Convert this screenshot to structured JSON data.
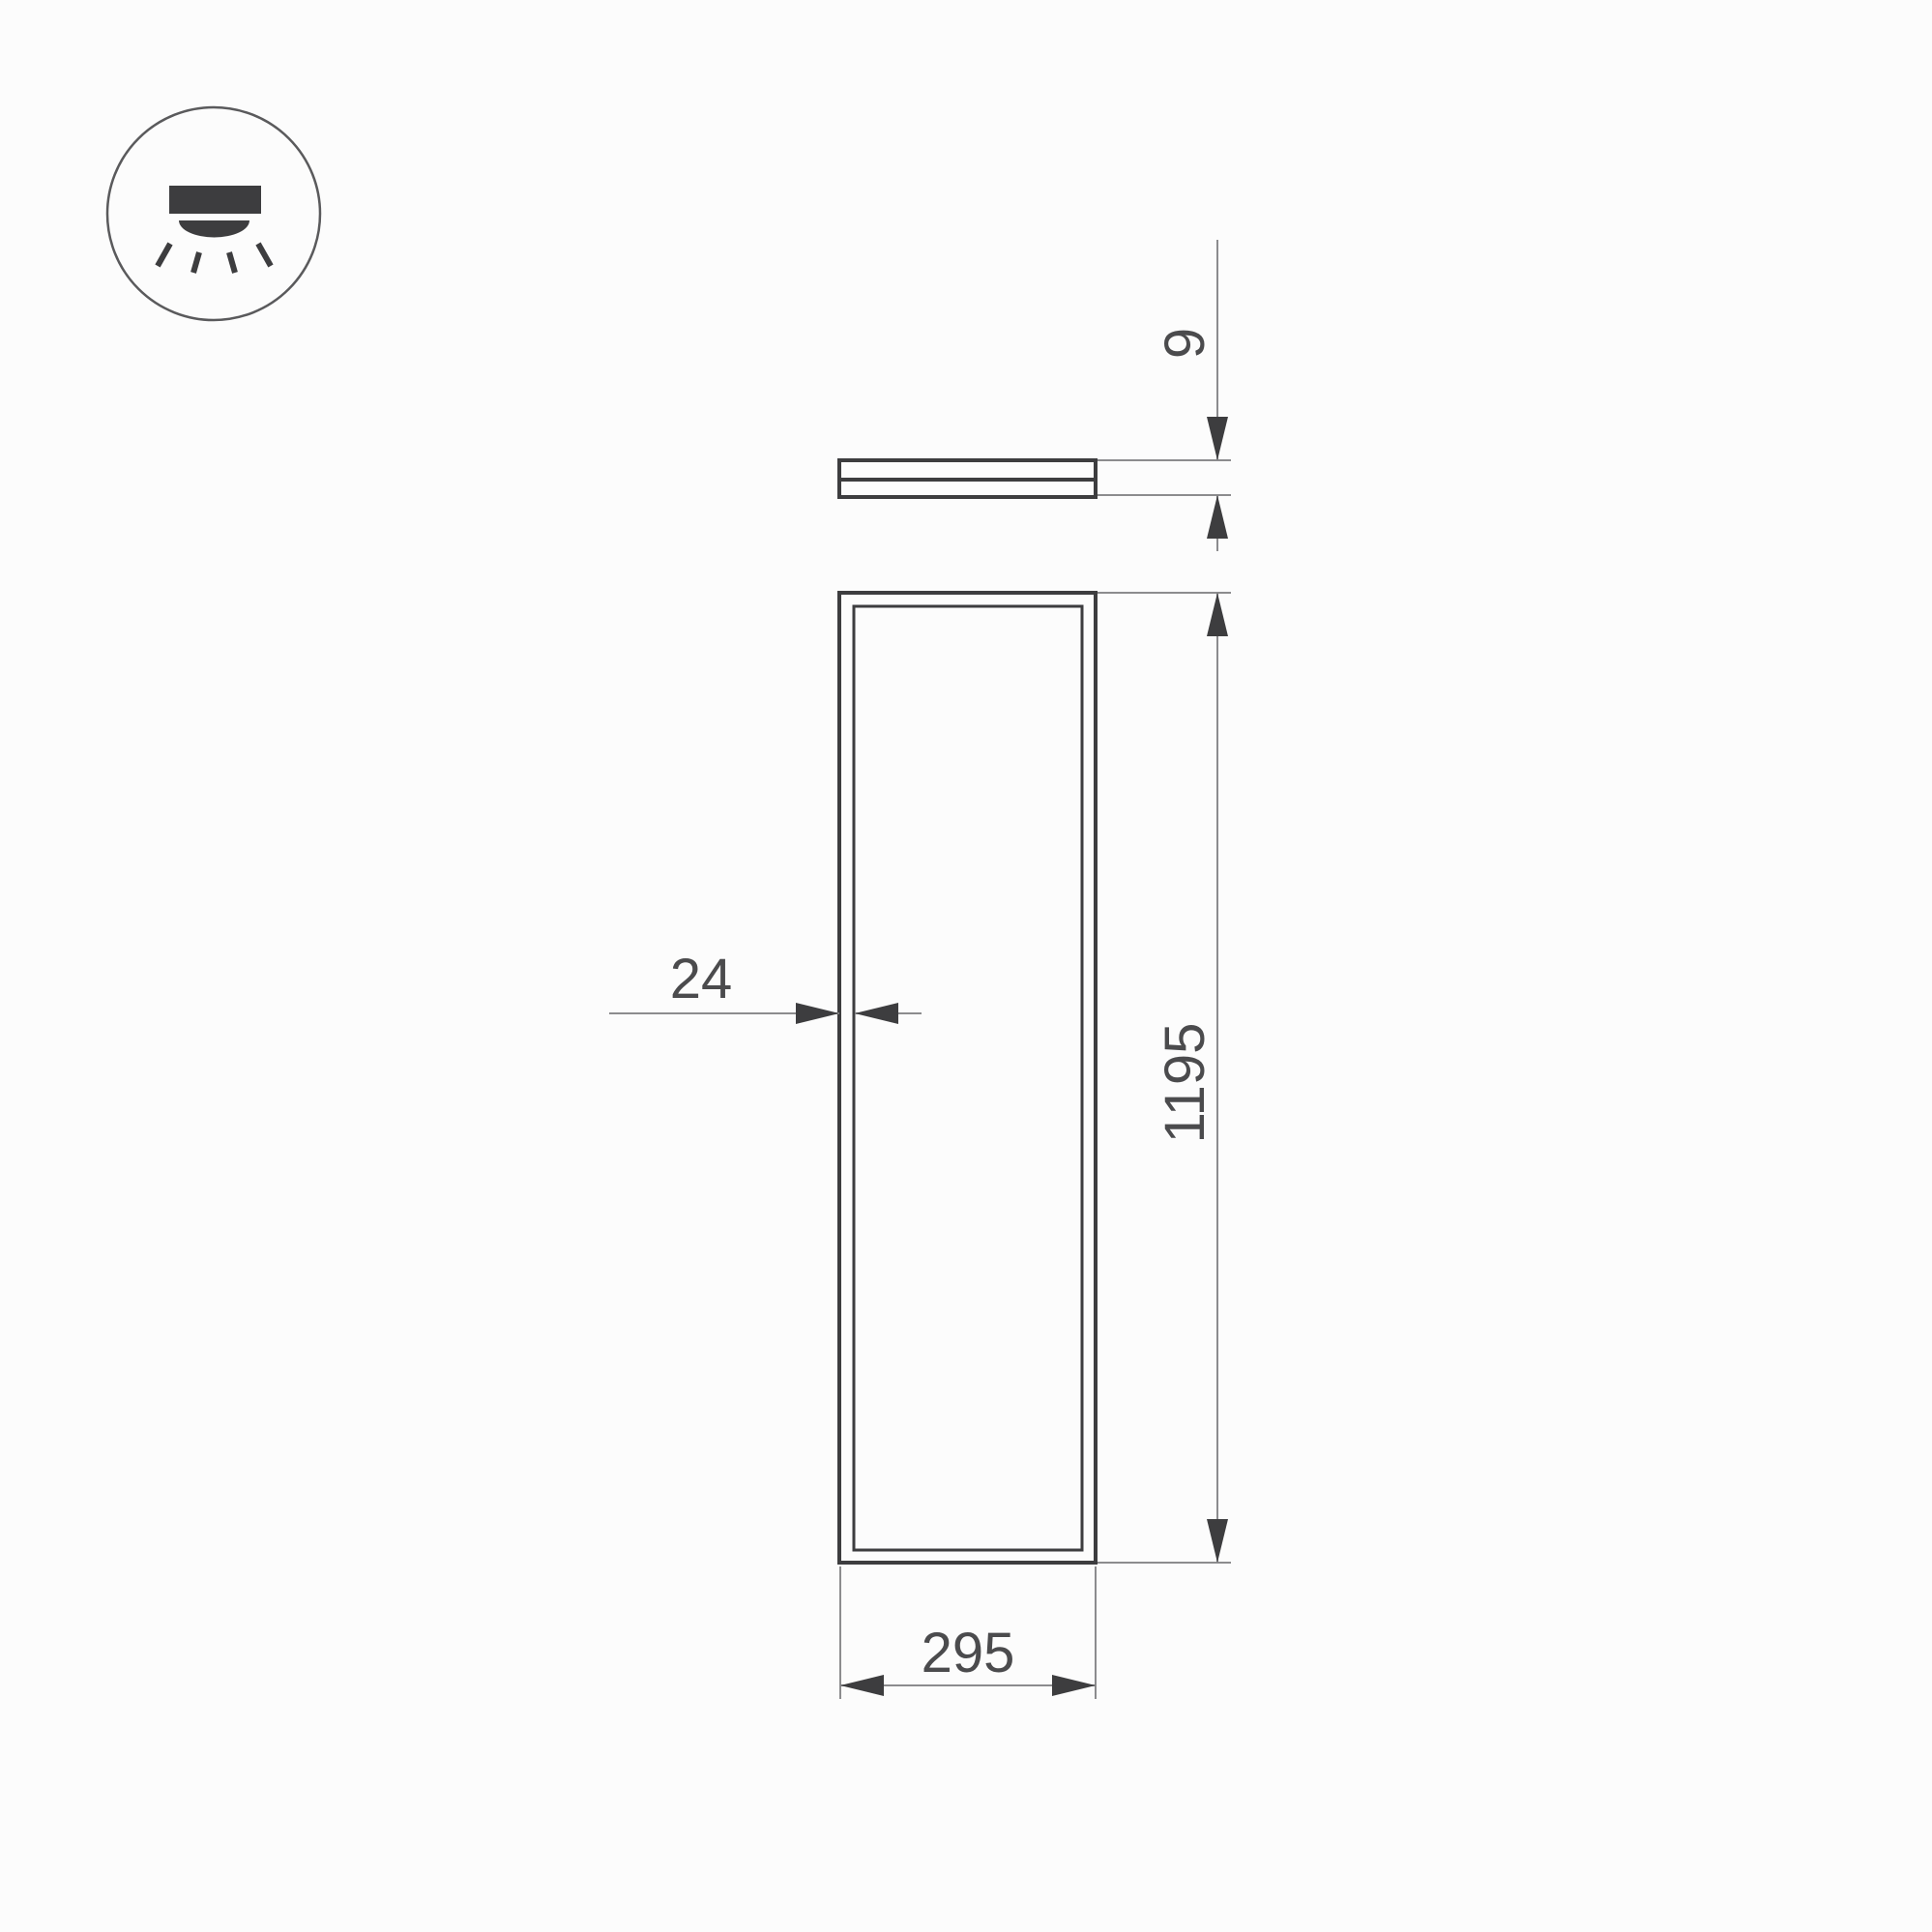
{
  "drawing": {
    "type": "technical-dimension-drawing",
    "views": {
      "side_view": "panel edge profile",
      "front_view": "panel face"
    }
  },
  "icon": {
    "name": "recessed-downlight-icon",
    "meaning": "ceiling light shining downward"
  },
  "dimensions": {
    "side_thickness": "9",
    "frame_border": "24",
    "width": "295",
    "height": "1195"
  },
  "colors": {
    "background": "#fcfcfc",
    "outline": "#3d3d3f",
    "thin_line": "#8c8c8e",
    "text": "#4b4b4d",
    "icon_stroke": "#5a5a5c"
  }
}
